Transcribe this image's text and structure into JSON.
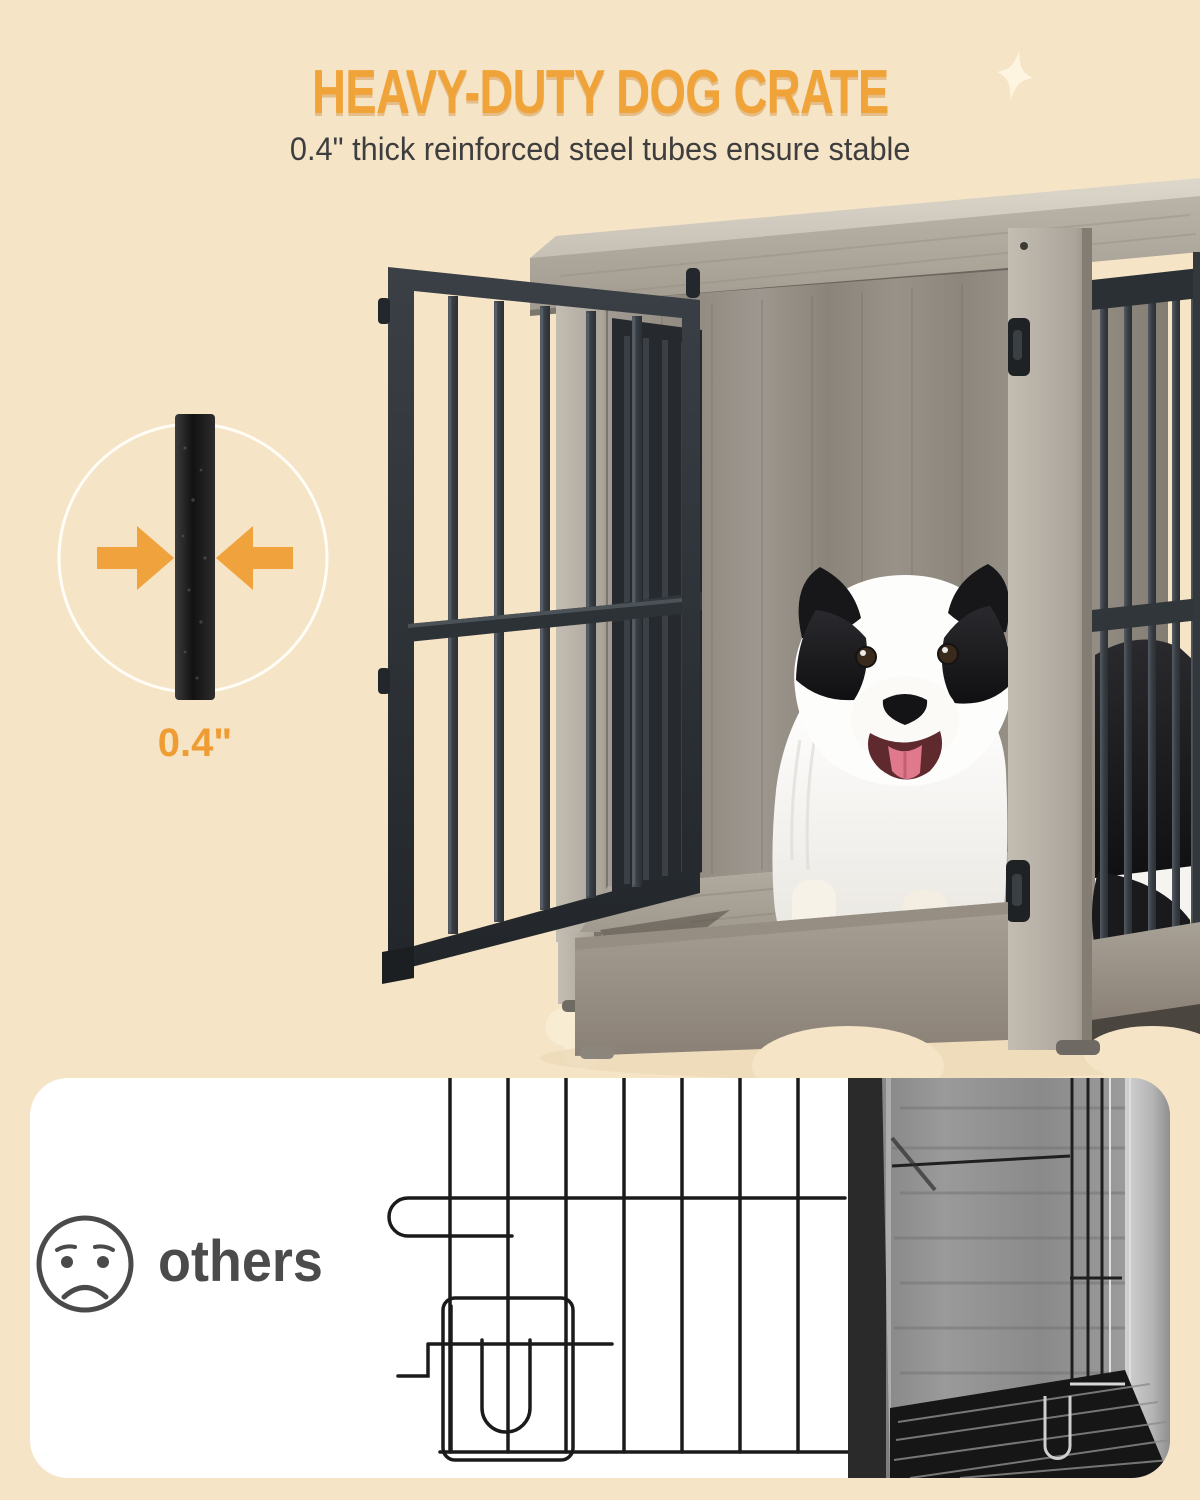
{
  "header": {
    "title": "HEAVY-DUTY DOG CRATE",
    "subtitle": "0.4\" thick reinforced steel tubes ensure stable"
  },
  "tube_detail": {
    "label": "0.4\""
  },
  "comparison": {
    "label": "others"
  },
  "colors": {
    "background": "#f5e4c6",
    "title_orange": "#f0a339",
    "arrow_orange": "#f0a23c",
    "label_orange": "#ef9d33",
    "subtitle_dark": "#3e3e3e",
    "comparison_grey": "#4b4b4b",
    "card_background": "#ffffff",
    "steel_black": "#2c3136",
    "wood_grey": "#a49d92"
  }
}
